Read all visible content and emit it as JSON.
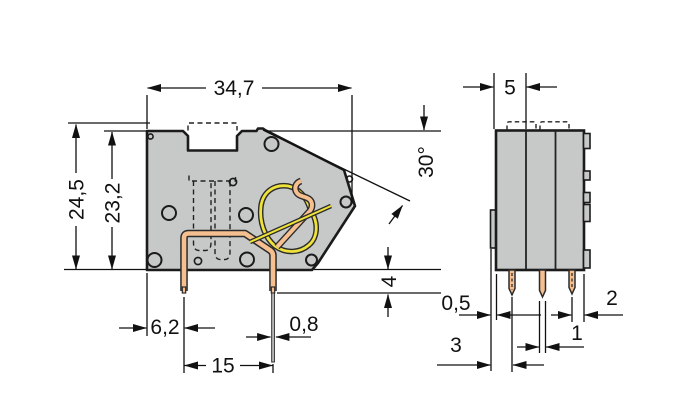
{
  "drawing": {
    "side_view": {
      "overall_width": "34,7",
      "total_height": "24,5",
      "housing_height": "23,2",
      "pushbutton_angle": "30°",
      "pin_protrusion": "4",
      "pin_offset": "6,2",
      "pin_spacing": "15",
      "pin_width": "0,8"
    },
    "front_view": {
      "pole_width": "5",
      "rib_width": "0,5",
      "edge_to_pin": "2",
      "pin_width": "1",
      "edge_to_pin_center": "3"
    }
  },
  "colors": {
    "housing": "#c6c9c8",
    "conductor_copper": "#f6bf90",
    "spring_steel": "#efe23a",
    "outline": "#1b1b1b",
    "background": "#ffffff"
  }
}
